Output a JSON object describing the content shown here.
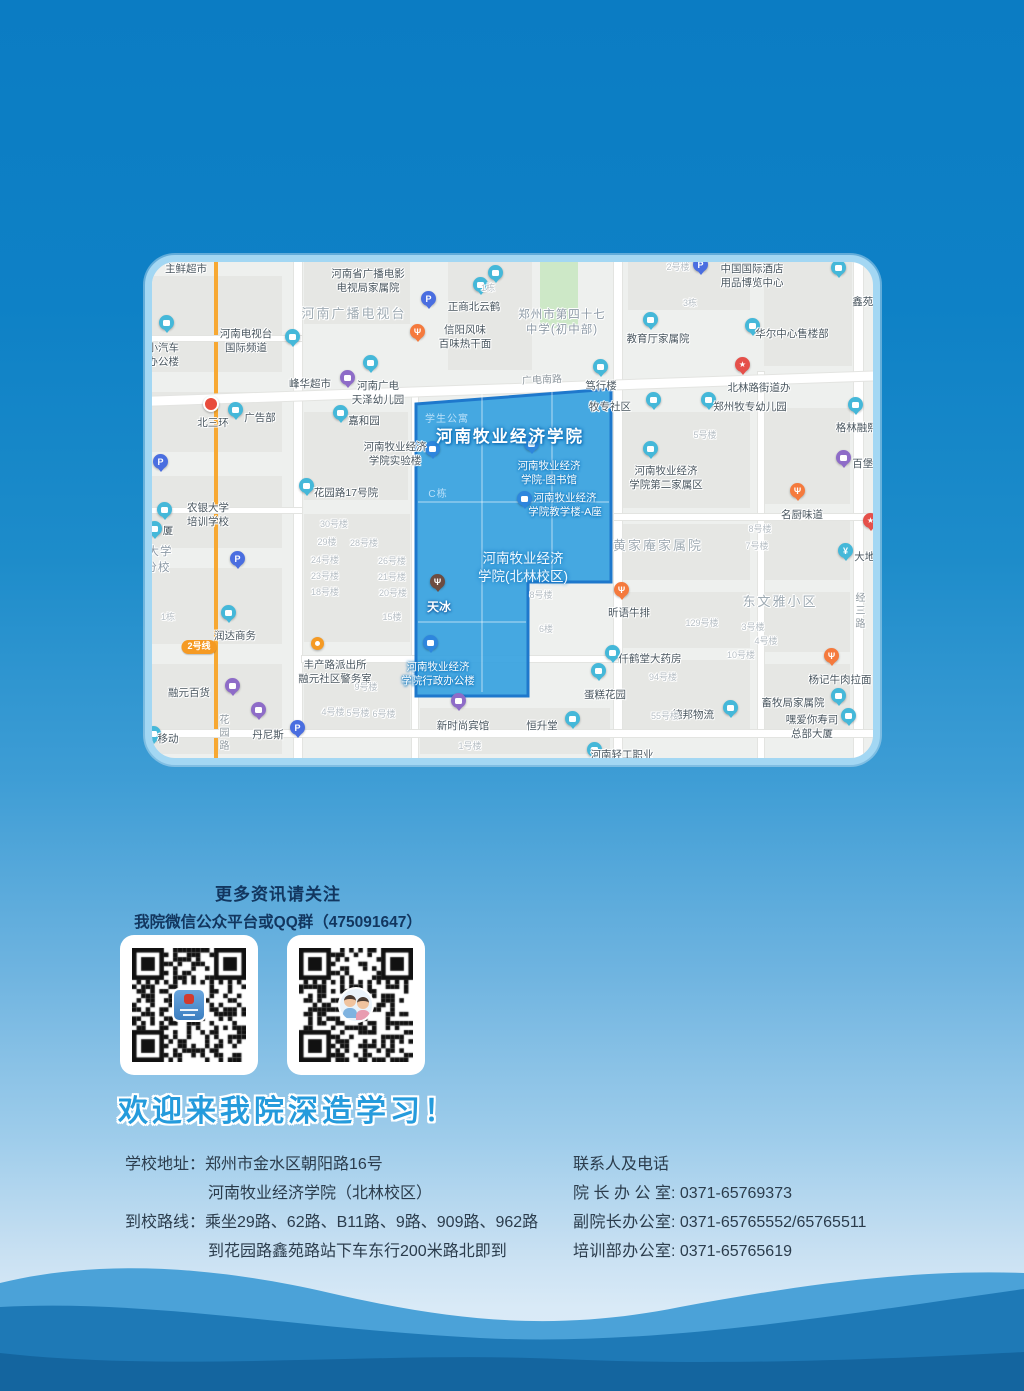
{
  "colors": {
    "page_top": "#0b7cc3",
    "page_bottom": "#dcedf8",
    "campus_fill": "#36a2df",
    "campus_stroke": "#1e78cc",
    "wave_light": "#4ba2d8",
    "wave_mid": "#1e79b6",
    "wave_dark": "#14659f",
    "map_border": "#a3d7f3"
  },
  "map": {
    "campus_name": "河南牧业经济学院",
    "campus_polygon": "264,142 459,127 459,320 376,320 376,434 264,434",
    "blocks": [
      [
        0,
        14,
        130,
        96
      ],
      [
        0,
        130,
        130,
        60
      ],
      [
        0,
        214,
        130,
        72
      ],
      [
        0,
        306,
        130,
        76
      ],
      [
        0,
        402,
        130,
        90
      ],
      [
        152,
        0,
        106,
        62
      ],
      [
        296,
        0,
        84,
        108
      ],
      [
        388,
        0,
        38,
        66,
        "#cde8c7"
      ],
      [
        476,
        0,
        122,
        48
      ],
      [
        612,
        0,
        88,
        104
      ],
      [
        152,
        150,
        104,
        88
      ],
      [
        152,
        252,
        106,
        128
      ],
      [
        152,
        398,
        106,
        72
      ],
      [
        268,
        446,
        190,
        46
      ],
      [
        470,
        150,
        128,
        96
      ],
      [
        470,
        262,
        128,
        56
      ],
      [
        470,
        330,
        128,
        56
      ],
      [
        470,
        398,
        128,
        70
      ],
      [
        612,
        146,
        86,
        96
      ],
      [
        612,
        258,
        86,
        60
      ],
      [
        612,
        330,
        86,
        60
      ],
      [
        612,
        402,
        86,
        70
      ]
    ],
    "roads": [
      {
        "x": 62,
        "y": 0,
        "w": 4,
        "h": 496,
        "c": "#f7a832"
      },
      {
        "x": 142,
        "y": 0,
        "w": 8,
        "h": 496
      },
      {
        "x": 462,
        "y": 0,
        "w": 8,
        "h": 496
      },
      {
        "x": 702,
        "y": 0,
        "w": 9,
        "h": 496
      },
      {
        "x": 260,
        "y": 130,
        "w": 6,
        "h": 366
      },
      {
        "x": 606,
        "y": 110,
        "w": 6,
        "h": 386
      },
      {
        "x": -12,
        "y": 122,
        "w": 748,
        "h": 9,
        "rot": -2
      },
      {
        "x": 0,
        "y": 74,
        "w": 150,
        "h": 5
      },
      {
        "x": 462,
        "y": 252,
        "w": 259,
        "h": 6
      },
      {
        "x": 0,
        "y": 246,
        "w": 150,
        "h": 5
      },
      {
        "x": 150,
        "y": 394,
        "w": 316,
        "h": 6
      },
      {
        "x": 0,
        "y": 468,
        "w": 721,
        "h": 7
      }
    ],
    "labels": [
      {
        "t": "主鲜超市",
        "x": 34,
        "y": 1
      },
      {
        "ls": [
          "河南省广播电影",
          "电视局家属院"
        ],
        "x": 216,
        "y": 6
      },
      {
        "t": "河南广播电视台",
        "x": 202,
        "y": 44,
        "k": "area"
      },
      {
        "t": "正商北云鹤",
        "x": 322,
        "y": 39
      },
      {
        "ls": [
          "信阳风味",
          "百味热干面"
        ],
        "x": 313,
        "y": 62
      },
      {
        "ls": [
          "郑州市第四十七",
          "中学(初中部)"
        ],
        "x": 410,
        "y": 46,
        "k": "area2"
      },
      {
        "t": "教育厅家属院",
        "x": 506,
        "y": 71
      },
      {
        "ls": [
          "中国国际酒店",
          "用品博览中心"
        ],
        "x": 600,
        "y": 1
      },
      {
        "t": "鑫苑金",
        "x": 716,
        "y": 34
      },
      {
        "t": "华尔中心售楼部",
        "x": 640,
        "y": 66
      },
      {
        "ls": [
          "河南电视台",
          "国际频道"
        ],
        "x": 94,
        "y": 66
      },
      {
        "ls": [
          "港小汽车",
          "合办公楼"
        ],
        "x": 6,
        "y": 80
      },
      {
        "t": "峰华超市",
        "x": 158,
        "y": 116
      },
      {
        "ls": [
          "河南广电",
          "天泽幼儿园"
        ],
        "x": 226,
        "y": 118
      },
      {
        "t": "广电南路",
        "x": 390,
        "y": 112,
        "k": "road",
        "rot": -3
      },
      {
        "t": "笃行楼",
        "x": 449,
        "y": 118
      },
      {
        "t": "北林路街道办",
        "x": 607,
        "y": 120
      },
      {
        "t": "牧专社区",
        "x": 458,
        "y": 139
      },
      {
        "t": "郑州牧专幼儿园",
        "x": 598,
        "y": 139
      },
      {
        "t": "北三环",
        "x": 61,
        "y": 155
      },
      {
        "t": "广告部",
        "x": 108,
        "y": 150
      },
      {
        "t": "嘉和园",
        "x": 212,
        "y": 153
      },
      {
        "t": "格林融熙国",
        "x": 710,
        "y": 160
      },
      {
        "t": "学生公寓",
        "x": 295,
        "y": 151,
        "k": "cfaint"
      },
      {
        "t": "河南牧业经济学院",
        "x": 358,
        "y": 165,
        "k": "cbig"
      },
      {
        "ls": [
          "河南牧业经济",
          "学院实验楼"
        ],
        "x": 243,
        "y": 179
      },
      {
        "t": "5号楼",
        "x": 553,
        "y": 168,
        "k": "faint"
      },
      {
        "t": "百堡滋",
        "x": 716,
        "y": 196
      },
      {
        "ls": [
          "河南牧业经济",
          "学院-图书馆"
        ],
        "x": 397,
        "y": 198,
        "k": "clab"
      },
      {
        "t": "花园路17号院",
        "x": 194,
        "y": 225
      },
      {
        "t": "C栋",
        "x": 286,
        "y": 226,
        "k": "cfaint"
      },
      {
        "ls": [
          "河南牧业经济",
          "学院第二家属区"
        ],
        "x": 514,
        "y": 203
      },
      {
        "ls": [
          "河南牧业经济",
          "学院教学楼-A座"
        ],
        "x": 413,
        "y": 230,
        "k": "clab"
      },
      {
        "t": "名厨味道",
        "x": 650,
        "y": 247
      },
      {
        "ls": [
          "农银大学",
          "培训学校"
        ],
        "x": 56,
        "y": 240
      },
      {
        "t": "黄家庵家属院",
        "x": 506,
        "y": 276,
        "k": "area"
      },
      {
        "t": "大地时",
        "x": 718,
        "y": 289
      },
      {
        "t": "30号楼",
        "x": 182,
        "y": 257,
        "k": "faint"
      },
      {
        "t": "29楼",
        "x": 175,
        "y": 275,
        "k": "faint"
      },
      {
        "t": "28号楼",
        "x": 212,
        "y": 276,
        "k": "faint"
      },
      {
        "t": "24号楼",
        "x": 173,
        "y": 293,
        "k": "faint"
      },
      {
        "t": "26号楼",
        "x": 240,
        "y": 294,
        "k": "faint"
      },
      {
        "t": "23号楼",
        "x": 173,
        "y": 309,
        "k": "faint"
      },
      {
        "t": "21号楼",
        "x": 240,
        "y": 310,
        "k": "faint"
      },
      {
        "t": "18号楼",
        "x": 173,
        "y": 325,
        "k": "faint"
      },
      {
        "t": "20号楼",
        "x": 241,
        "y": 326,
        "k": "faint"
      },
      {
        "t": "15楼",
        "x": 240,
        "y": 350,
        "k": "faint"
      },
      {
        "t": "8号楼",
        "x": 608,
        "y": 262,
        "k": "faint"
      },
      {
        "t": "7号楼",
        "x": 605,
        "y": 279,
        "k": "faint"
      },
      {
        "t": "大学",
        "x": 8,
        "y": 283,
        "k": "area2"
      },
      {
        "t": "分校",
        "x": 6,
        "y": 299,
        "k": "area2"
      },
      {
        "t": "厦",
        "x": 16,
        "y": 263
      },
      {
        "t": "天冰",
        "x": 287,
        "y": 338,
        "k": "clab2"
      },
      {
        "ls": [
          "河南牧业经济",
          "学院(北林校区)"
        ],
        "x": 371,
        "y": 288,
        "k": "cmed"
      },
      {
        "t": "8号楼",
        "x": 389,
        "y": 328,
        "k": "faint"
      },
      {
        "t": "昕语牛排",
        "x": 477,
        "y": 345
      },
      {
        "t": "东文雅小区",
        "x": 628,
        "y": 332,
        "k": "area"
      },
      {
        "t": "经三路",
        "x": 700,
        "y": 330,
        "k": "vroad"
      },
      {
        "t": "129号楼",
        "x": 550,
        "y": 356,
        "k": "faint"
      },
      {
        "t": "3号楼",
        "x": 601,
        "y": 360,
        "k": "faint"
      },
      {
        "t": "6楼",
        "x": 394,
        "y": 362,
        "k": "faint"
      },
      {
        "t": "润达商务",
        "x": 83,
        "y": 368
      },
      {
        "t": "仟鹤堂大药房",
        "x": 498,
        "y": 391
      },
      {
        "t": "4号楼",
        "x": 614,
        "y": 374,
        "k": "faint"
      },
      {
        "t": "10号楼",
        "x": 589,
        "y": 388,
        "k": "faint"
      },
      {
        "t": "1栋",
        "x": 16,
        "y": 350,
        "k": "faint"
      },
      {
        "t": "2号线",
        "x": 47,
        "y": 378,
        "k": "metro"
      },
      {
        "ls": [
          "丰产路派出所",
          "融元社区警务室"
        ],
        "x": 183,
        "y": 397
      },
      {
        "t": "9号楼",
        "x": 214,
        "y": 420,
        "k": "faint"
      },
      {
        "t": "94号楼",
        "x": 511,
        "y": 410,
        "k": "faint"
      },
      {
        "t": "杨记牛肉拉面",
        "x": 688,
        "y": 412
      },
      {
        "t": "融元百货",
        "x": 37,
        "y": 425
      },
      {
        "ls": [
          "河南牧业经济",
          "学院行政办公楼"
        ],
        "x": 286,
        "y": 399,
        "k": "clab"
      },
      {
        "t": "蛋糕花园",
        "x": 453,
        "y": 427
      },
      {
        "t": "畜牧局家属院",
        "x": 641,
        "y": 435
      },
      {
        "t": "德邦物流",
        "x": 541,
        "y": 447
      },
      {
        "t": "4号楼",
        "x": 181,
        "y": 445,
        "k": "faint"
      },
      {
        "t": "5号楼",
        "x": 206,
        "y": 446,
        "k": "faint"
      },
      {
        "t": "6号楼",
        "x": 232,
        "y": 447,
        "k": "faint"
      },
      {
        "t": "新时尚宾馆",
        "x": 311,
        "y": 458
      },
      {
        "t": "恒升堂",
        "x": 390,
        "y": 458
      },
      {
        "t": "55号楼",
        "x": 513,
        "y": 449,
        "k": "faint"
      },
      {
        "t": "丹尼斯",
        "x": 116,
        "y": 467
      },
      {
        "ls": [
          "嘿爱你寿司",
          "总部大厦"
        ],
        "x": 660,
        "y": 452
      },
      {
        "t": "移动",
        "x": 16,
        "y": 471
      },
      {
        "t": "花园路",
        "x": 64,
        "y": 452,
        "k": "vroad"
      },
      {
        "t": "1号楼",
        "x": 318,
        "y": 479,
        "k": "faint"
      },
      {
        "t": "河南轻工职业",
        "x": 470,
        "y": 487
      },
      {
        "t": "1栋",
        "x": 336,
        "y": 21,
        "k": "faint"
      },
      {
        "t": "3栋",
        "x": 538,
        "y": 36,
        "k": "faint"
      },
      {
        "t": "2号楼",
        "x": 526,
        "y": 0,
        "k": "faint"
      }
    ],
    "pins": [
      {
        "x": 343,
        "y": 10,
        "k": "teal"
      },
      {
        "x": 328,
        "y": 22,
        "k": "teal"
      },
      {
        "x": 686,
        "y": 5,
        "k": "teal"
      },
      {
        "x": 600,
        "y": 63,
        "k": "teal"
      },
      {
        "x": 498,
        "y": 57,
        "k": "teal"
      },
      {
        "x": 140,
        "y": 74,
        "k": "teal"
      },
      {
        "x": 14,
        "y": 60,
        "k": "teal"
      },
      {
        "x": 218,
        "y": 100,
        "k": "teal"
      },
      {
        "x": 448,
        "y": 104,
        "k": "teal"
      },
      {
        "x": 501,
        "y": 137,
        "k": "teal"
      },
      {
        "x": 556,
        "y": 137,
        "k": "teal"
      },
      {
        "x": 83,
        "y": 147,
        "k": "teal"
      },
      {
        "x": 188,
        "y": 150,
        "k": "teal"
      },
      {
        "x": 703,
        "y": 142,
        "k": "teal"
      },
      {
        "x": 498,
        "y": 186,
        "k": "teal"
      },
      {
        "x": 154,
        "y": 223,
        "k": "teal"
      },
      {
        "x": 12,
        "y": 247,
        "k": "teal"
      },
      {
        "x": 2,
        "y": 266,
        "k": "teal"
      },
      {
        "x": 76,
        "y": 350,
        "k": "teal"
      },
      {
        "x": 460,
        "y": 390,
        "k": "teal"
      },
      {
        "x": 446,
        "y": 408,
        "k": "teal"
      },
      {
        "x": 686,
        "y": 433,
        "k": "teal"
      },
      {
        "x": 578,
        "y": 445,
        "k": "teal"
      },
      {
        "x": 420,
        "y": 456,
        "k": "teal"
      },
      {
        "x": 696,
        "y": 453,
        "k": "teal"
      },
      {
        "x": 1,
        "y": 471,
        "k": "teal"
      },
      {
        "x": 442,
        "y": 487,
        "k": "teal"
      },
      {
        "x": 280,
        "y": 186,
        "k": "blue"
      },
      {
        "x": 379,
        "y": 181,
        "k": "blue"
      },
      {
        "x": 372,
        "y": 236,
        "k": "blue"
      },
      {
        "x": 278,
        "y": 380,
        "k": "blue"
      },
      {
        "x": 195,
        "y": 115,
        "k": "purple"
      },
      {
        "x": 691,
        "y": 195,
        "k": "purple"
      },
      {
        "x": 80,
        "y": 423,
        "k": "purple"
      },
      {
        "x": 106,
        "y": 447,
        "k": "purple"
      },
      {
        "x": 306,
        "y": 438,
        "k": "purple"
      },
      {
        "x": 265,
        "y": 69,
        "k": "orange"
      },
      {
        "x": 645,
        "y": 228,
        "k": "orange"
      },
      {
        "x": 469,
        "y": 327,
        "k": "orange"
      },
      {
        "x": 679,
        "y": 393,
        "k": "orange"
      },
      {
        "x": 590,
        "y": 102,
        "k": "star"
      },
      {
        "x": 718,
        "y": 258,
        "k": "star"
      },
      {
        "x": 276,
        "y": 36,
        "k": "p"
      },
      {
        "x": 548,
        "y": 2,
        "k": "p"
      },
      {
        "x": 8,
        "y": 199,
        "k": "p"
      },
      {
        "x": 85,
        "y": 296,
        "k": "p"
      },
      {
        "x": 145,
        "y": 465,
        "k": "p"
      },
      {
        "x": 58,
        "y": 141,
        "k": "reddot"
      },
      {
        "x": 166,
        "y": 382,
        "k": "police"
      },
      {
        "x": 285,
        "y": 319,
        "k": "brown"
      },
      {
        "x": 693,
        "y": 288,
        "k": "bank"
      }
    ]
  },
  "follow": {
    "title": "更多资讯请关注",
    "subtitle": "我院微信公众平台或QQ群（475091647）"
  },
  "qr": {
    "left_name": "wechat-official-account-qr",
    "right_name": "qq-group-qr"
  },
  "welcome": "欢迎来我院深造学习！",
  "contact": {
    "left": [
      {
        "label": "学校地址：",
        "text": "郑州市金水区朝阳路16号"
      },
      {
        "label": "",
        "text": "河南牧业经济学院（北林校区）"
      },
      {
        "label": "到校路线：",
        "text": "乘坐29路、62路、B11路、9路、909路、962路"
      },
      {
        "label": "",
        "text": "到花园路鑫苑路站下车东行200米路北即到"
      }
    ],
    "right": {
      "header": "联系人及电话",
      "separator": ": ",
      "rows": [
        {
          "label": "院长办公室",
          "value": "0371-65769373"
        },
        {
          "label": "副院长办公室",
          "value": "0371-65765552/65765511"
        },
        {
          "label": "培训部办公室",
          "value": "0371-65765619"
        }
      ]
    }
  }
}
